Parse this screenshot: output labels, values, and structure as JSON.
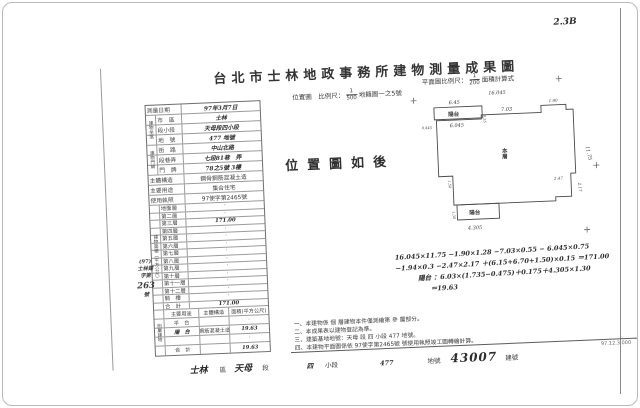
{
  "corner_mark": "2.3B",
  "title": "台北市士林地政事務所建物測量成果圖",
  "header": {
    "location_scale_label": "位置圖　比例尺：",
    "location_scale_num": "1",
    "location_scale_den": "500",
    "cadastre_ref": "地籍圖一之5號",
    "plan_scale_label": "平面圖比例尺：",
    "plan_scale_num": "1",
    "plan_scale_den": "200",
    "area_calc_label": "面積計算式"
  },
  "info_table": {
    "group_location": "建物坐落",
    "group_address": "建物門牌",
    "rows": [
      {
        "label": "測量日期",
        "value": "97年3月7日"
      },
      {
        "label": "市　區",
        "value": "士林"
      },
      {
        "label": "段小段",
        "value": "天母段四小段"
      },
      {
        "label": "地　號",
        "value": "477 地號"
      },
      {
        "label": "街　路",
        "value": "中山北路"
      },
      {
        "label": "段巷弄",
        "value": "七段81巷　弄"
      },
      {
        "label": "門　牌",
        "value": "78之5號 3樓"
      },
      {
        "label": "主體構造",
        "value": "鋼骨鋼筋混凝土造"
      },
      {
        "label": "主要用途",
        "value": "集合住宅"
      },
      {
        "label": "使用執照",
        "value": "97使字第2465號"
      }
    ]
  },
  "floor_table": {
    "section_label": "建物面積（平方公尺）",
    "rows": [
      {
        "label": "地面層",
        "value": "·"
      },
      {
        "label": "第二層",
        "value": "·"
      },
      {
        "label": "第三層",
        "value": "171.00"
      },
      {
        "label": "第四層",
        "value": "·"
      },
      {
        "label": "第五層",
        "value": "·"
      },
      {
        "label": "第六層",
        "value": "·"
      },
      {
        "label": "第七層",
        "value": "·"
      },
      {
        "label": "第八層",
        "value": "·"
      },
      {
        "label": "第九層",
        "value": "·"
      },
      {
        "label": "第十層",
        "value": "·"
      },
      {
        "label": "第十一層",
        "value": "·"
      },
      {
        "label": "第十二層",
        "value": "·"
      },
      {
        "label": "騎　樓",
        "value": "·"
      },
      {
        "label": "合　計",
        "value": "171.00"
      }
    ]
  },
  "annex_table": {
    "section_label": "附屬建物",
    "col_use": "主要用途",
    "col_structure": "主體構造",
    "col_area": "面積(平方公尺)",
    "rows": [
      {
        "use": "平　台",
        "structure": "",
        "area": "·"
      },
      {
        "use": "陽　台",
        "structure": "鋼筋混凝土造",
        "area": "19.63"
      },
      {
        "use": "",
        "structure": "",
        "area": "·"
      },
      {
        "use": "合　計",
        "structure": "",
        "area": "19.63"
      }
    ]
  },
  "stamp": {
    "line1": "(97)",
    "line2": "士林建",
    "line3": "字第",
    "line4": "263",
    "line5": "號"
  },
  "location_note": "位置圖如後",
  "plan": {
    "room_label": "本層",
    "balcony_top_label": "陽台",
    "balcony_bottom_label": "陽台",
    "dims": {
      "top": "16.045",
      "balcony_outer": "6.45",
      "balcony_inner": "6.045",
      "balcony_left": "0.445",
      "balcony_depth": "0.55",
      "top_mid": "7.03",
      "top_right": "1.90",
      "right": "11.75",
      "notch_w": "2.47",
      "notch_h": "2.17",
      "bottom_balcony": "4.305",
      "left_step": "1.50",
      "balcony_b_left": "1.30"
    }
  },
  "calc": {
    "line1": "16.045×11.75 −1.90×1.28 −7.03×0.55 − 6.045×0.75",
    "line2": "−1.94×0.3 −2.47×2.17 ＋(6.15+6.70+1.50)×0.15 ＝171.00",
    "line3": "陽台 ：6.03×(1.735−0.475)＋0.175＋4.305×1.30",
    "line4": "＝19.63"
  },
  "notes": [
    "一、本建物係 個 層建物本件僅測繪第 參 層部分。",
    "二、本成果表以建物登記為準。",
    "三、建築基地地號：天母 段 四 小段 477 地號。",
    "四、本建物平面圖係依 97使字第2465號 號使用執照竣工圖轉繪計算。"
  ],
  "footer": {
    "district": "士林",
    "district_label": "區",
    "section": "天母",
    "section_label": "段",
    "subsection": "四",
    "subsection_label": "小段",
    "parcel": "477",
    "parcel_label": "地號",
    "building_no": "43007",
    "building_label": "建號"
  },
  "print_code": "97.12.3,000"
}
